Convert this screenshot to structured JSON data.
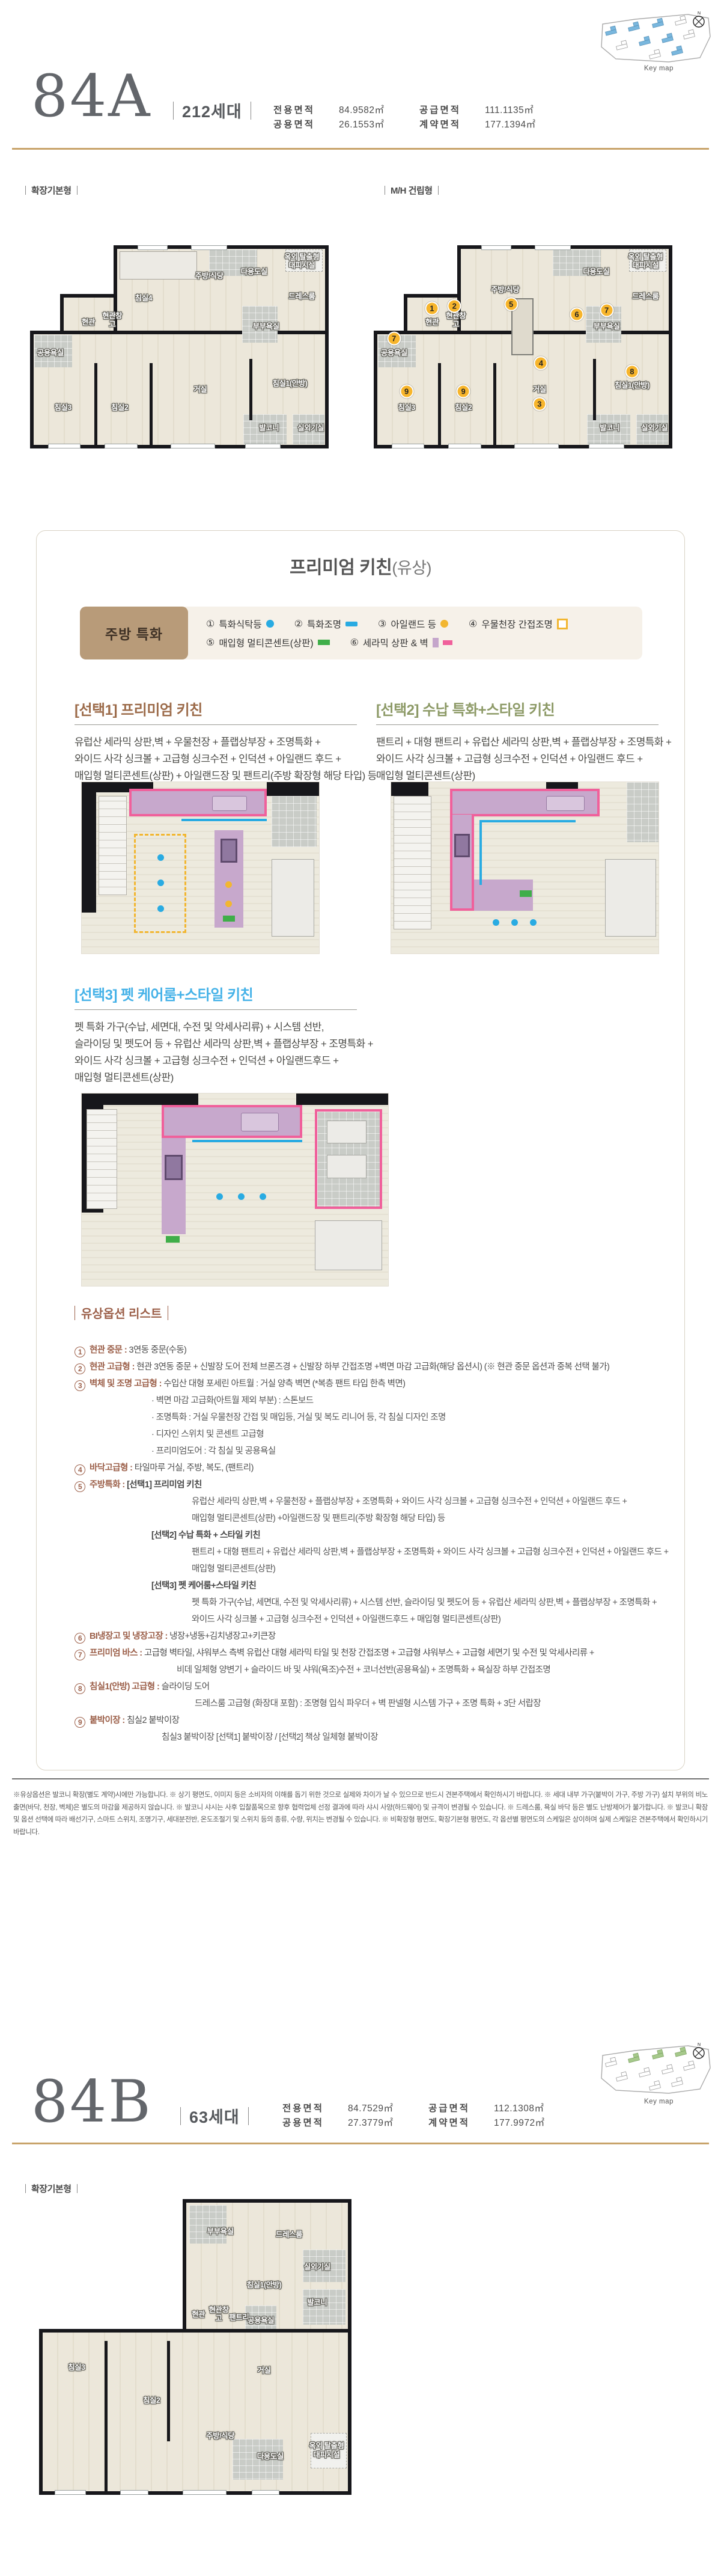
{
  "unit_a": {
    "name": "84A",
    "households": "212세대",
    "areas": [
      {
        "label": "전용면적",
        "value": "84.9582㎡"
      },
      {
        "label": "공급면적",
        "value": "111.1135㎡"
      },
      {
        "label": "공용면적",
        "value": "26.1553㎡"
      },
      {
        "label": "계약면적",
        "value": "177.1394㎡"
      }
    ],
    "keymap_label": "Key map",
    "plan_left_label": "확장기본형",
    "plan_right_label": "M/H 건립형",
    "rooms": [
      "침실4",
      "주방/식당",
      "다용도실",
      "옥외 탈출형 대피시설",
      "드레스룸",
      "현관",
      "현관창고",
      "부부욕실",
      "공용욕실",
      "거실",
      "침실1(안방)",
      "침실2",
      "침실3",
      "발코니",
      "실외기실"
    ],
    "mh_rooms": [
      "주방/식당",
      "다용도실",
      "옥외 탈출형 대피시설",
      "드레스룸",
      "현관",
      "현관창고",
      "부부욕실",
      "공용욕실",
      "거실",
      "침실1(안방)",
      "침실2",
      "침실3",
      "발코니",
      "실외기실"
    ],
    "markers": [
      "1",
      "2",
      "5",
      "6",
      "7",
      "7",
      "4",
      "3",
      "8",
      "9",
      "9"
    ]
  },
  "kitchen": {
    "title": "프리미엄 키친",
    "title_suffix": "(유상)",
    "legend_tab": "주방 특화",
    "legend": [
      {
        "num": "①",
        "label": "특화식탁등"
      },
      {
        "num": "②",
        "label": "특화조명"
      },
      {
        "num": "③",
        "label": "아일랜드 등"
      },
      {
        "num": "④",
        "label": "우물천장 간접조명"
      },
      {
        "num": "⑤",
        "label": "매입형 멀티콘센트(상판)"
      },
      {
        "num": "⑥",
        "label": "세라믹 상판 & 벽"
      }
    ],
    "options": [
      {
        "heading": "[선택1] 프리미엄 키친",
        "lines": [
          "유럽산 세라믹 상판,벽 + 우물천장 + 플랩상부장 + 조명특화 +",
          "와이드 사각 싱크볼 + 고급형 싱크수전 + 인덕션 + 아일랜드 후드 +",
          "매입형 멀티콘센트(상판) + 아일랜드장 및 팬트리(주방 확장형 해당 타입) 등"
        ]
      },
      {
        "heading": "[선택2] 수납 특화+스타일 키친",
        "lines": [
          "팬트리 + 대형 팬트리 + 유럽산 세라믹 상판,벽 + 플랩상부장 + 조명특화 +",
          "와이드 사각 싱크볼 + 고급형 싱크수전 + 인덕션 + 아일랜드 후드 +",
          "매입형 멀티콘센트(상판)"
        ]
      },
      {
        "heading": "[선택3] 펫 케어룸+스타일 키친",
        "lines": [
          "펫 특화 가구(수납, 세면대, 수전 및 악세사리류) + 시스템 선반,",
          "슬라이딩 및 펫도어 등 + 유럽산 세라믹 상판,벽 + 플랩상부장 + 조명특화 +",
          "와이드 사각 싱크볼 + 고급형 싱크수전 + 인덕션 + 아일랜드후드 +",
          "매입형 멀티콘센트(상판)"
        ]
      }
    ],
    "accent_colors": {
      "option1": "#9c6b4a",
      "option2": "#8d9a67",
      "option3": "#45b2e8",
      "legend_blue": "#29abe2",
      "legend_yellow": "#f2b630",
      "legend_green": "#3fae49",
      "ceramic_lavender": "#c5a6cb",
      "ceramic_pink": "#f0609b"
    }
  },
  "paid_options": {
    "title": "유상옵션 리스트",
    "items": [
      {
        "num": "1",
        "label": "현관 중문",
        "text": "3연동 중문(수동)",
        "subs": []
      },
      {
        "num": "2",
        "label": "현관 고급형",
        "text": "현관 3연동 중문 + 신발장 도어 전체 브론즈경 + 신발장 하부 간접조명 +벽면 마감 고급화(해당 옵션시) (※ 현관 중문 옵션과 중복 선택 불가)",
        "subs": []
      },
      {
        "num": "3",
        "label": "벽체 및 조명 고급형",
        "text": "수입산 대형 포세린 아트월 : 거실 양측 벽면 (*복층 팬트 타입 한측 벽면)",
        "subs": [
          "· 벽면 마감 고급화(아트월 제외 부분) : 스톤보드",
          "· 조명특화 : 거실 우물천장 간접 및 매입등, 거실 및 복도 리니어 등, 각 침실 디자인 조명",
          "· 디자인 스위치 및 콘센트 고급형",
          "· 프리미엄도어 : 각 침실 및 공용욕실"
        ]
      },
      {
        "num": "4",
        "label": "바닥고급형",
        "text": "타일마루 거실, 주방, 복도, (팬트리)",
        "subs": []
      },
      {
        "num": "5",
        "label": "주방특화",
        "text": "[선택1] 프리미엄 키친",
        "subs": [
          "유럽산 세라믹 상판,벽 + 우물천장 + 플랩상부장 + 조명특화 + 와이드 사각 싱크볼 + 고급형 싱크수전 + 인덕션 + 아일랜드 후드 +",
          "매입형 멀티콘센트(상판) +아일랜드장 및 팬트리(주방 확장형 해당 타입) 등",
          "[선택2] 수납 특화 + 스타일 키친",
          "팬트리 + 대형 팬트리 + 유럽산 세라믹 상판,벽 + 플랩상부장 + 조명특화 + 와이드 사각 싱크볼 + 고급형 싱크수전 + 인덕션 + 아일랜드 후드 +",
          "매입형 멀티콘센트(상판)",
          "[선택3] 펫 케어룸+스타일 키친",
          "펫 특화 가구(수납, 세면대, 수전 및 악세사리류) + 시스템 선반, 슬라이딩 및 펫도어 등 + 유럽산 세라믹 상판,벽 + 플랩상부장 + 조명특화 +",
          "와이드 사각 싱크볼 + 고급형 싱크수전 + 인덕션 + 아일랜드후드 + 매입형 멀티콘센트(상판)"
        ]
      },
      {
        "num": "6",
        "label": "BI냉장고 및 냉장고장",
        "text": "냉장+냉동+김치냉장고+키큰장",
        "subs": []
      },
      {
        "num": "7",
        "label": "프리미엄 바스",
        "text": "고급형 벽타일, 샤워부스 측벽 유럽산 대형 세라믹 타일 및 천장 간접조명 + 고급형 샤워부스 + 고급형 세면기 및 수전 및 악세사리류 +",
        "subs": [
          "비데 일체형 양변기 + 슬라이드 바 및 샤워(욕조)수전 + 코너선반(공용욕실) + 조명특화 + 욕실장 하부 간접조명"
        ]
      },
      {
        "num": "8",
        "label": "침실1(안방) 고급형",
        "text": "슬라이딩 도어",
        "subs": [
          "드레스룸 고급형 (화장대 포함) : 조명형 입식 파우더 + 벽 판넬형 시스템 가구 + 조명 특화 + 3단 서랍장"
        ]
      },
      {
        "num": "9",
        "label": "붙박이장",
        "text": "침실2 붙박이장",
        "subs": [
          "침실3 붙박이장 [선택1] 붙박이장 / [선택2] 책상 일체형 붙박이장"
        ]
      }
    ]
  },
  "disclaimer": "※유상옵션은 발코니 확장(별도 계약)시에만 가능합니다. ※ 상기 평면도, 이미지 등은 소비자의 이해를 돕기 위한 것으로 실제와 차이가 날 수 있으므로 반드시 견본주택에서 확인하시기 바랍니다. ※ 세대 내부 가구(붙박이 가구, 주방 가구) 설치 부위의 비노출면(바닥, 천장, 벽체)은 별도의 마감을 제공하지 않습니다. ※ 발코니 샤시는 사후 입찰품목으로 향후 협력업체 선정 결과에 따라 샤시 사양(하드웨어) 및 규격이 변경될 수 있습니다. ※ 드레스룸, 욕실 바닥 등은 별도 난방제어가 불가합니다. ※ 발코니 확장 및 옵션 선택에 따라 배선기구, 스마트 스위치, 조명기구, 세대분전반, 온도조절기 및 스위치 등의 종류, 수량, 위치는 변경될 수 있습니다. ※ 비확장형 평면도, 확장기본형 평면도, 각 옵션별 평면도의 스케일은 상이하며 실제 스케일은 견본주택에서 확인하시기 바랍니다.",
  "unit_b": {
    "name": "84B",
    "households": "63세대",
    "areas": [
      {
        "label": "전용면적",
        "value": "84.7529㎡"
      },
      {
        "label": "공급면적",
        "value": "112.1308㎡"
      },
      {
        "label": "공용면적",
        "value": "27.3779㎡"
      },
      {
        "label": "계약면적",
        "value": "177.9972㎡"
      }
    ],
    "keymap_label": "Key map",
    "plan_label": "확장기본형",
    "rooms": [
      "부부욕실",
      "드레스룸",
      "실외기실",
      "침실1(안방)",
      "발코니",
      "현관",
      "현관창고",
      "팬트리",
      "공용욕실",
      "침실3",
      "침실2",
      "거실",
      "주방/식당",
      "다용도실",
      "옥외 탈출형 대피시설"
    ]
  }
}
